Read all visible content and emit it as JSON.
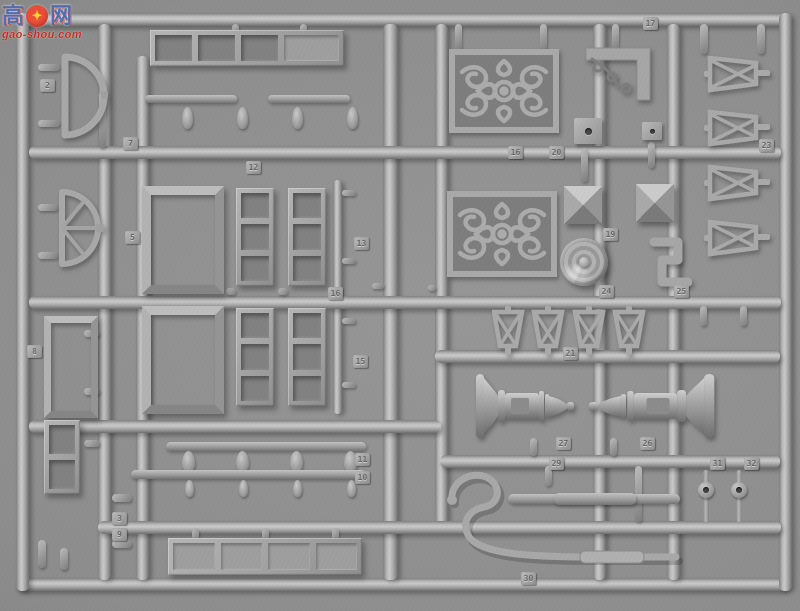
{
  "scene": {
    "type": "photograph",
    "subject": "Gray injection-molded plastic model-kit sprue with Chinese architectural parts: window frames, door panels, scrollwork lattice screens, turned balusters, railings and brackets, photographed on a gray background",
    "plastic_color": "#a5a5a5",
    "background_color": "#8d8d8d"
  },
  "watermark": {
    "left_char": "高",
    "right_char": "网",
    "gear_glyph": "✦",
    "url": "gao-shou.com",
    "blue": "#4d6cb0",
    "red": "#c9281e",
    "yellow": "#ffd91c"
  },
  "part_tags": [
    {
      "label": "2",
      "x": 40,
      "y": 79
    },
    {
      "label": "7",
      "x": 123,
      "y": 137
    },
    {
      "label": "12",
      "x": 246,
      "y": 161
    },
    {
      "label": "5",
      "x": 125,
      "y": 231
    },
    {
      "label": "13",
      "x": 354,
      "y": 237
    },
    {
      "label": "16",
      "x": 328,
      "y": 287
    },
    {
      "label": "15",
      "x": 353,
      "y": 355
    },
    {
      "label": "8",
      "x": 27,
      "y": 345
    },
    {
      "label": "17",
      "x": 643,
      "y": 17
    },
    {
      "label": "16",
      "x": 508,
      "y": 146
    },
    {
      "label": "20",
      "x": 549,
      "y": 146
    },
    {
      "label": "19",
      "x": 603,
      "y": 228
    },
    {
      "label": "23",
      "x": 759,
      "y": 139
    },
    {
      "label": "24",
      "x": 599,
      "y": 285
    },
    {
      "label": "25",
      "x": 674,
      "y": 285
    },
    {
      "label": "21",
      "x": 563,
      "y": 347
    },
    {
      "label": "27",
      "x": 556,
      "y": 437
    },
    {
      "label": "26",
      "x": 640,
      "y": 437
    },
    {
      "label": "29",
      "x": 549,
      "y": 457
    },
    {
      "label": "31",
      "x": 710,
      "y": 457
    },
    {
      "label": "32",
      "x": 744,
      "y": 457
    },
    {
      "label": "30",
      "x": 521,
      "y": 572
    },
    {
      "label": "11",
      "x": 355,
      "y": 453
    },
    {
      "label": "10",
      "x": 355,
      "y": 471
    },
    {
      "label": "3",
      "x": 112,
      "y": 512
    },
    {
      "label": "9",
      "x": 112,
      "y": 528
    }
  ],
  "visible_parts": [
    "semicircular fanlight frame",
    "spoked fan window",
    "long shutter panel with three openings and one recessed panel",
    "two large plain door frames",
    "four three-pane window sashes",
    "two ornate scrollwork lattice panels",
    "carved corner bracket",
    "two pyramid post caps",
    "round ribbed disc",
    "four trapezoid cross-braced stands",
    "two turned balusters laid tip to tip",
    "curved swan-neck hook",
    "straight rods",
    "railing strips with vase spindles",
    "long paneled plank",
    "four cross-braced trapezoid frames",
    "small pierced square plates",
    "two round-head pins with holes"
  ]
}
